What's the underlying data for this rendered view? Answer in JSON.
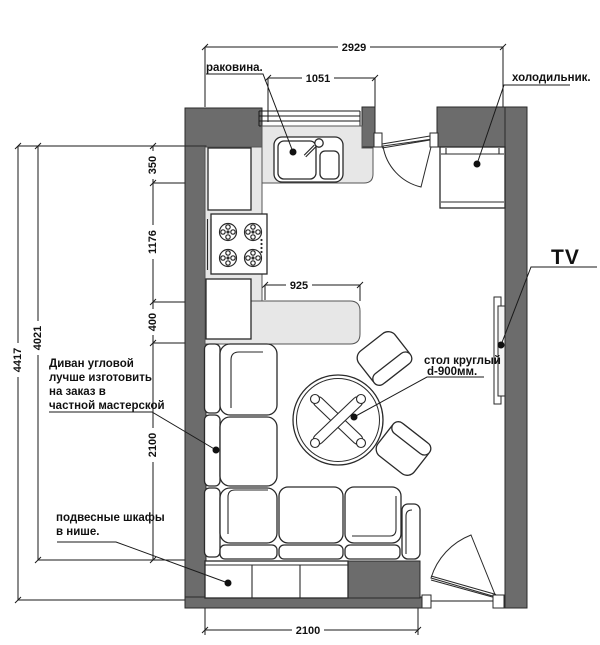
{
  "title": "kitchen-living-room floor plan",
  "colors": {
    "wall": "#6c6c6c",
    "counter": "#e7e7e7",
    "line": "#1a1a1a",
    "bg": "#ffffff"
  },
  "labels": {
    "sink": "раковина.",
    "fridge": "холодильник.",
    "tv": "TV",
    "table_line1": "стол круглый",
    "table_line2": "d-900мм.",
    "sofa_line1": "Диван угловой",
    "sofa_line2": "лучше изготовить",
    "sofa_line3": "на заказ в",
    "sofa_line4": "частной мастерской",
    "cabinets_line1": "подвесные шкафы",
    "cabinets_line2": "в нише."
  },
  "dimensions": {
    "top_width": "2929",
    "sink_run": "1051",
    "counter_depth": "350",
    "kitchen_side": "1176",
    "bar_depth": "400",
    "sofa_side": "2100",
    "outer_height": "4417",
    "inner_height": "4021",
    "bar_length": "925",
    "bottom_width": "2100"
  }
}
